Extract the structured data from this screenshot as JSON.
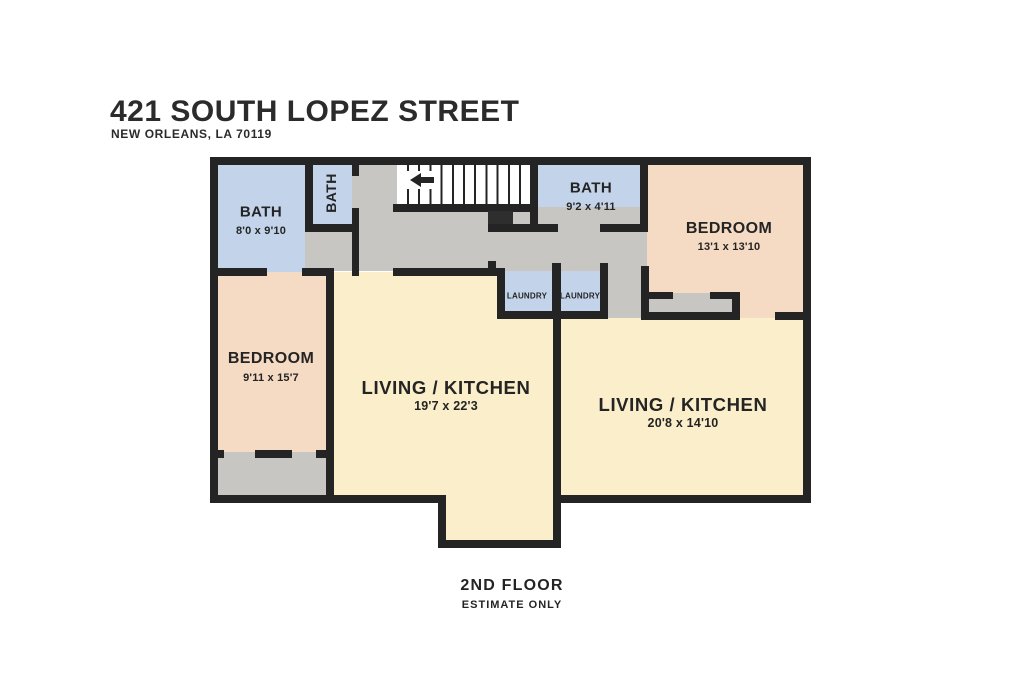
{
  "header": {
    "title": "421 SOUTH LOPEZ STREET",
    "subtitle": "NEW ORLEANS, LA 70119"
  },
  "rooms": {
    "bath_left": {
      "name": "BATH",
      "dims": "8'0 x 9'10"
    },
    "bath_small": {
      "name": "BATH"
    },
    "bath_top": {
      "name": "BATH",
      "dims": "9'2 x 4'11"
    },
    "bedroom_right": {
      "name": "BEDROOM",
      "dims": "13'1 x 13'10"
    },
    "bedroom_left": {
      "name": "BEDROOM",
      "dims": "9'11 x 15'7"
    },
    "living_left": {
      "name": "LIVING / KITCHEN",
      "dims": "19'7 x 22'3"
    },
    "living_right": {
      "name": "LIVING / KITCHEN",
      "dims": "20'8 x 14'10"
    },
    "laundry_left": {
      "name": "LAUNDRY"
    },
    "laundry_right": {
      "name": "LAUNDRY"
    }
  },
  "footer": {
    "floor": "2ND FLOOR",
    "note": "ESTIMATE ONLY"
  },
  "icons": {
    "stairs_arrow": "left-arrow"
  },
  "palette": {
    "wall": "#242424",
    "bath": "#c2d3ea",
    "bedroom": "#f5dac4",
    "living": "#fbeeca",
    "hall": "#c8c6c3",
    "stairs": "#ffffff",
    "background": "#ffffff",
    "text": "#242424"
  }
}
